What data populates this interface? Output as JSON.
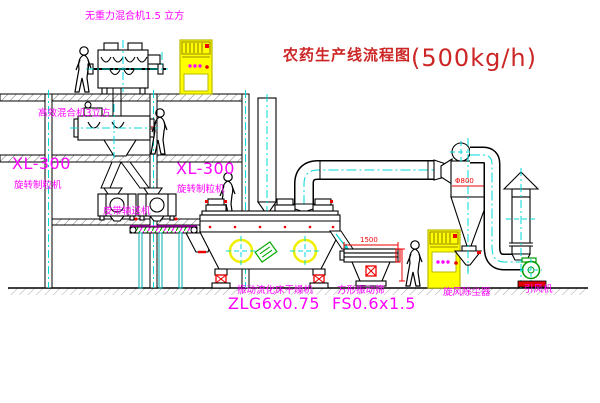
{
  "title": {
    "name": "农药生产线流程图",
    "capacity": "(500kg/h)"
  },
  "equipment_labels": {
    "gravity_mixer": "无重力混合机1.5 立方",
    "high_eff_mixer": "高效混合机3立方",
    "granulator_left": {
      "model": "XL-300",
      "name": "旋转制粒机"
    },
    "granulator_right": {
      "model": "XL-300",
      "name": "旋转制粒机"
    },
    "belt_conveyor": "皮带输送机",
    "dryer": {
      "name": "振动流化床干燥机",
      "model": "ZLG6x0.75"
    },
    "sieve": {
      "name": "方形振动筛",
      "model": "FS0.6x1.5"
    },
    "cyclone": "旋风除尘器",
    "fan": "引风机"
  },
  "dimensions": {
    "sieve_length": "1500",
    "cyclone_diameter": "Φ800"
  },
  "colors": {
    "label_magenta": "#ff00ff",
    "title_red": "#cc2626",
    "centerline_cyan": "#00d8d8",
    "equipment_yellow": "#ffff00",
    "accent_red": "#ee0000",
    "accent_green": "#00aa00",
    "line_black": "#000000"
  }
}
